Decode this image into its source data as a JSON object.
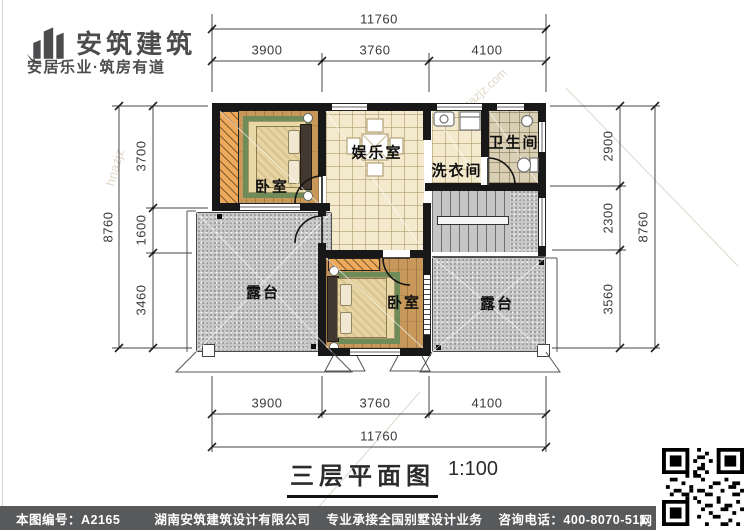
{
  "brand": {
    "name": "安筑建筑",
    "tagline": "安居乐业·筑房有道"
  },
  "plan": {
    "rooms": [
      {
        "id": "bedroom-upper",
        "label": "卧室"
      },
      {
        "id": "entertainment",
        "label": "娱乐室"
      },
      {
        "id": "laundry",
        "label": "洗衣间"
      },
      {
        "id": "bathroom",
        "label": "卫生间"
      },
      {
        "id": "terrace-left",
        "label": "露台"
      },
      {
        "id": "bedroom-lower",
        "label": "卧室"
      },
      {
        "id": "terrace-right",
        "label": "露台"
      }
    ],
    "dimensions": {
      "top": {
        "total": "11760",
        "segments": [
          "3900",
          "3760",
          "4100"
        ]
      },
      "bottom": {
        "total": "11760",
        "segments": [
          "3900",
          "3760",
          "4100"
        ]
      },
      "left": {
        "total": "8760",
        "segments": [
          "3700",
          "1600",
          "3460"
        ]
      },
      "right": {
        "total": "8760",
        "segments": [
          "2900",
          "2300",
          "3560"
        ]
      }
    },
    "watermarks": [
      "安筑建筑",
      "hnazjz.com",
      "hnazjz"
    ]
  },
  "title_block": {
    "title": "三层平面图",
    "scale": "1:100"
  },
  "footer": {
    "drawing_no": "本图编号：A2165",
    "company": "湖南安筑建筑设计有限公司",
    "service": "专业承接全国别墅设计业务",
    "phone": "咨询电话：400-8070-511",
    "web_label": "网",
    "bar_color": "#58595b"
  },
  "colors": {
    "wall": "#181818",
    "wood_floor": "#c8985a",
    "tile_floor": "#f3e9cd",
    "bath_tile": "#d9cfb4",
    "terrace": "#c8c8c8",
    "wardrobe": "#eda95c",
    "rug_border": "#6f8b58",
    "footer_bar": "#58595b"
  }
}
